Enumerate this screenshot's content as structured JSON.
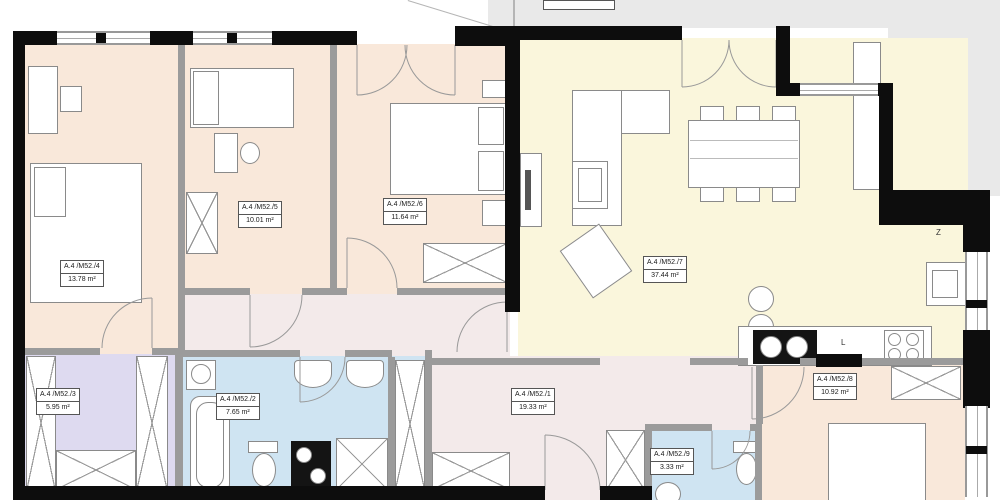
{
  "floorplan": {
    "unit_labels": {
      "r1": {
        "name": "A.4 /M52./1",
        "area": "19.33 m²"
      },
      "r2": {
        "name": "A.4 /M52./2",
        "area": "7.65 m²"
      },
      "r3": {
        "name": "A.4 /M52./3",
        "area": "5.95 m²"
      },
      "r4": {
        "name": "A.4 /M52./4",
        "area": "13.78 m²"
      },
      "r5": {
        "name": "A.4 /M52./5",
        "area": "10.01 m²"
      },
      "r6": {
        "name": "A.4 /M52./6",
        "area": "11.64 m²"
      },
      "r7": {
        "name": "A.4 /M52./7",
        "area": "37.44 m²"
      },
      "r8": {
        "name": "A.4 /M52./8",
        "area": "10.92 m²"
      },
      "r9": {
        "name": "A.4 /M52./9",
        "area": "3.33 m²"
      }
    },
    "kitchen_marks": {
      "l_mark": "L",
      "z_mark": "Z"
    },
    "colors": {
      "bedroom_floor": "#f9e8da",
      "living_floor": "#faf6dc",
      "hall_floor": "#f3eaea",
      "wet_floor": "#cfe4f2",
      "closet_floor": "#dedaf0",
      "outside": "#e9e9e9",
      "wall": "#0d0d0d"
    }
  }
}
